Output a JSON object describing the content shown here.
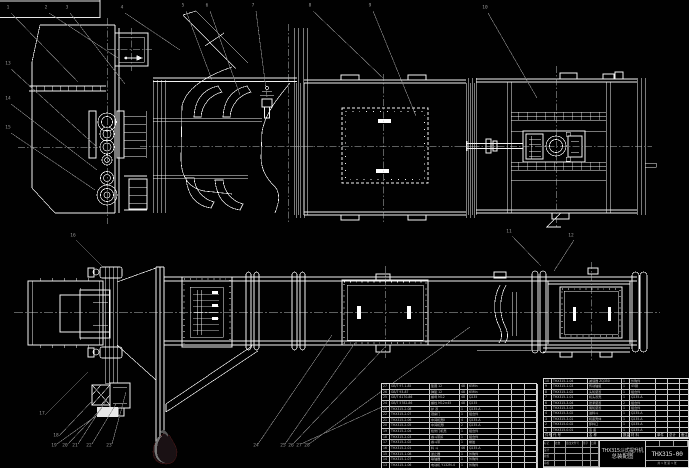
{
  "drawing": {
    "title_line1": "THX315斗式提升机",
    "title_line2": "总装配图",
    "drawing_no": "THX315-00",
    "sheet_info": "共 1 张  第 1 张"
  },
  "title_grid": {
    "col_widths": [
      11,
      11,
      17,
      8,
      8
    ],
    "rows": [
      [
        "标记",
        "处数",
        "更改文件号",
        "签字",
        "日期"
      ],
      [
        "设计",
        "",
        "",
        "",
        ""
      ],
      [
        "校核",
        "",
        "",
        "",
        ""
      ],
      [
        "审核",
        "",
        "",
        "",
        ""
      ]
    ]
  },
  "left_bom": {
    "x": 381,
    "y": 383,
    "w": 156,
    "row_h": 5.65,
    "col_widths": [
      8,
      40,
      30,
      8,
      31,
      13,
      13,
      13
    ],
    "rows": [
      [
        "27",
        "GB/T 97.1-85",
        "垫圈 12",
        "48",
        "65Mn",
        "",
        "",
        ""
      ],
      [
        "26",
        "GB/T 93-87",
        "弹垫 12",
        "48",
        "65Mn",
        "",
        "",
        ""
      ],
      [
        "25",
        "GB/T 6170-86",
        "螺母 M12",
        "48",
        "Q235",
        "",
        "",
        ""
      ],
      [
        "24",
        "GB/T 5782-86",
        "螺栓 M12×45",
        "48",
        "Q235",
        "",
        "",
        ""
      ],
      [
        "23",
        "THX315-2-08",
        "护 罩",
        "1",
        "Q235-A",
        "",
        "",
        ""
      ],
      [
        "22",
        "THX315-2-07",
        "观察门",
        "1",
        "组合件",
        "",
        "",
        ""
      ],
      [
        "21",
        "THX315-2-06",
        "中间机壳Ⅱ",
        "4",
        "Q235-A",
        "",
        "",
        ""
      ],
      [
        "20",
        "THX315-2-05",
        "中间机壳Ⅰ",
        "2",
        "Q235-A",
        "",
        "",
        ""
      ],
      [
        "19",
        "THX315-2-04",
        "检修门机壳",
        "1",
        "组合件",
        "",
        "",
        ""
      ],
      [
        "18",
        "THX315-2-03",
        "畚斗带扣",
        "1",
        "组合件",
        "",
        "",
        ""
      ],
      [
        "17",
        "THX315-2-02",
        "畚斗带",
        "1",
        "橡胶",
        "",
        "",
        ""
      ],
      [
        "16",
        "THX315-2-01",
        "料 斗",
        "46",
        "Q235-A",
        "",
        "",
        ""
      ],
      [
        "15",
        "THX315-1-08",
        "逆止器",
        "1",
        "外购件",
        "",
        "",
        ""
      ],
      [
        "14",
        "THX315-1-07",
        "联轴器",
        "1",
        "外购件",
        "",
        "",
        ""
      ],
      [
        "13",
        "THX315-1-06",
        "电动机 Y132M-4",
        "1",
        "外购件",
        "",
        "",
        ""
      ]
    ]
  },
  "right_bom": {
    "x": 543,
    "y": 378,
    "w": 146,
    "row_h": 5.4,
    "col_widths": [
      8,
      36,
      34,
      8,
      26,
      12,
      12,
      10
    ],
    "rows": [
      [
        "10",
        "THX315-1-04",
        "减速器 ZQ350",
        "1",
        "外购件",
        "",
        "",
        ""
      ],
      [
        "9",
        "THX315-1-03",
        "传动轴组",
        "1",
        "45钢",
        "",
        "",
        ""
      ],
      [
        "8",
        "THX315-1-02",
        "头轮装置",
        "1",
        "组合件",
        "",
        "",
        ""
      ],
      [
        "7",
        "THX315-1-01",
        "机头罩壳",
        "1",
        "Q235-A",
        "",
        "",
        ""
      ],
      [
        "6",
        "THX315-3-04",
        "张紧装置",
        "2",
        "组合件",
        "",
        "",
        ""
      ],
      [
        "5",
        "THX315-3-03",
        "尾轮装置",
        "1",
        "组合件",
        "",
        "",
        ""
      ],
      [
        "4",
        "THX315-3-02",
        "进料斗",
        "1",
        "Q235-A",
        "",
        "",
        ""
      ],
      [
        "3",
        "THX315-3-01",
        "机座壳体",
        "1",
        "Q235-A",
        "",
        "",
        ""
      ],
      [
        "2",
        "THX315-0-02",
        "卸料口",
        "1",
        "Q235-A",
        "",
        "",
        ""
      ],
      [
        "1",
        "THX315-0-01",
        "底 座",
        "1",
        "Q235-A",
        "",
        "",
        ""
      ]
    ],
    "header": [
      "件号",
      "代 号",
      "名 称",
      "数量",
      "材 料",
      "单件",
      "总计",
      "备注"
    ]
  },
  "callouts": [
    {
      "x": 8,
      "y": 8,
      "n": "1"
    },
    {
      "x": 46,
      "y": 8,
      "n": "2"
    },
    {
      "x": 67,
      "y": 8,
      "n": "3"
    },
    {
      "x": 122,
      "y": 8,
      "n": "4"
    },
    {
      "x": 183,
      "y": 6,
      "n": "5"
    },
    {
      "x": 207,
      "y": 6,
      "n": "6"
    },
    {
      "x": 253,
      "y": 6,
      "n": "7"
    },
    {
      "x": 310,
      "y": 6,
      "n": "8"
    },
    {
      "x": 370,
      "y": 6,
      "n": "9"
    },
    {
      "x": 485,
      "y": 8,
      "n": "10"
    },
    {
      "x": 509,
      "y": 232,
      "n": "11"
    },
    {
      "x": 571,
      "y": 236,
      "n": "12"
    },
    {
      "x": 8,
      "y": 64,
      "n": "13"
    },
    {
      "x": 8,
      "y": 99,
      "n": "14"
    },
    {
      "x": 8,
      "y": 128,
      "n": "15"
    },
    {
      "x": 73,
      "y": 236,
      "n": "16"
    },
    {
      "x": 42,
      "y": 414,
      "n": "17"
    },
    {
      "x": 56,
      "y": 436,
      "n": "18"
    },
    {
      "x": 54,
      "y": 446,
      "n": "19"
    },
    {
      "x": 65,
      "y": 446,
      "n": "20"
    },
    {
      "x": 75,
      "y": 446,
      "n": "21"
    },
    {
      "x": 89,
      "y": 446,
      "n": "22"
    },
    {
      "x": 109,
      "y": 446,
      "n": "23"
    },
    {
      "x": 256,
      "y": 446,
      "n": "24"
    },
    {
      "x": 283,
      "y": 446,
      "n": "25"
    },
    {
      "x": 291,
      "y": 446,
      "n": "26"
    },
    {
      "x": 299,
      "y": 446,
      "n": "27"
    },
    {
      "x": 307,
      "y": 446,
      "n": "28"
    }
  ],
  "colors": {
    "background": "#010101",
    "line": "#f2f2f2",
    "centerline": "#b9bdbd",
    "leader": "#8a8a8a",
    "table_border": "#d9d9d9",
    "logo_body": "#1a1114",
    "logo_rim": "#451515",
    "logo_highlight": "#787878"
  }
}
